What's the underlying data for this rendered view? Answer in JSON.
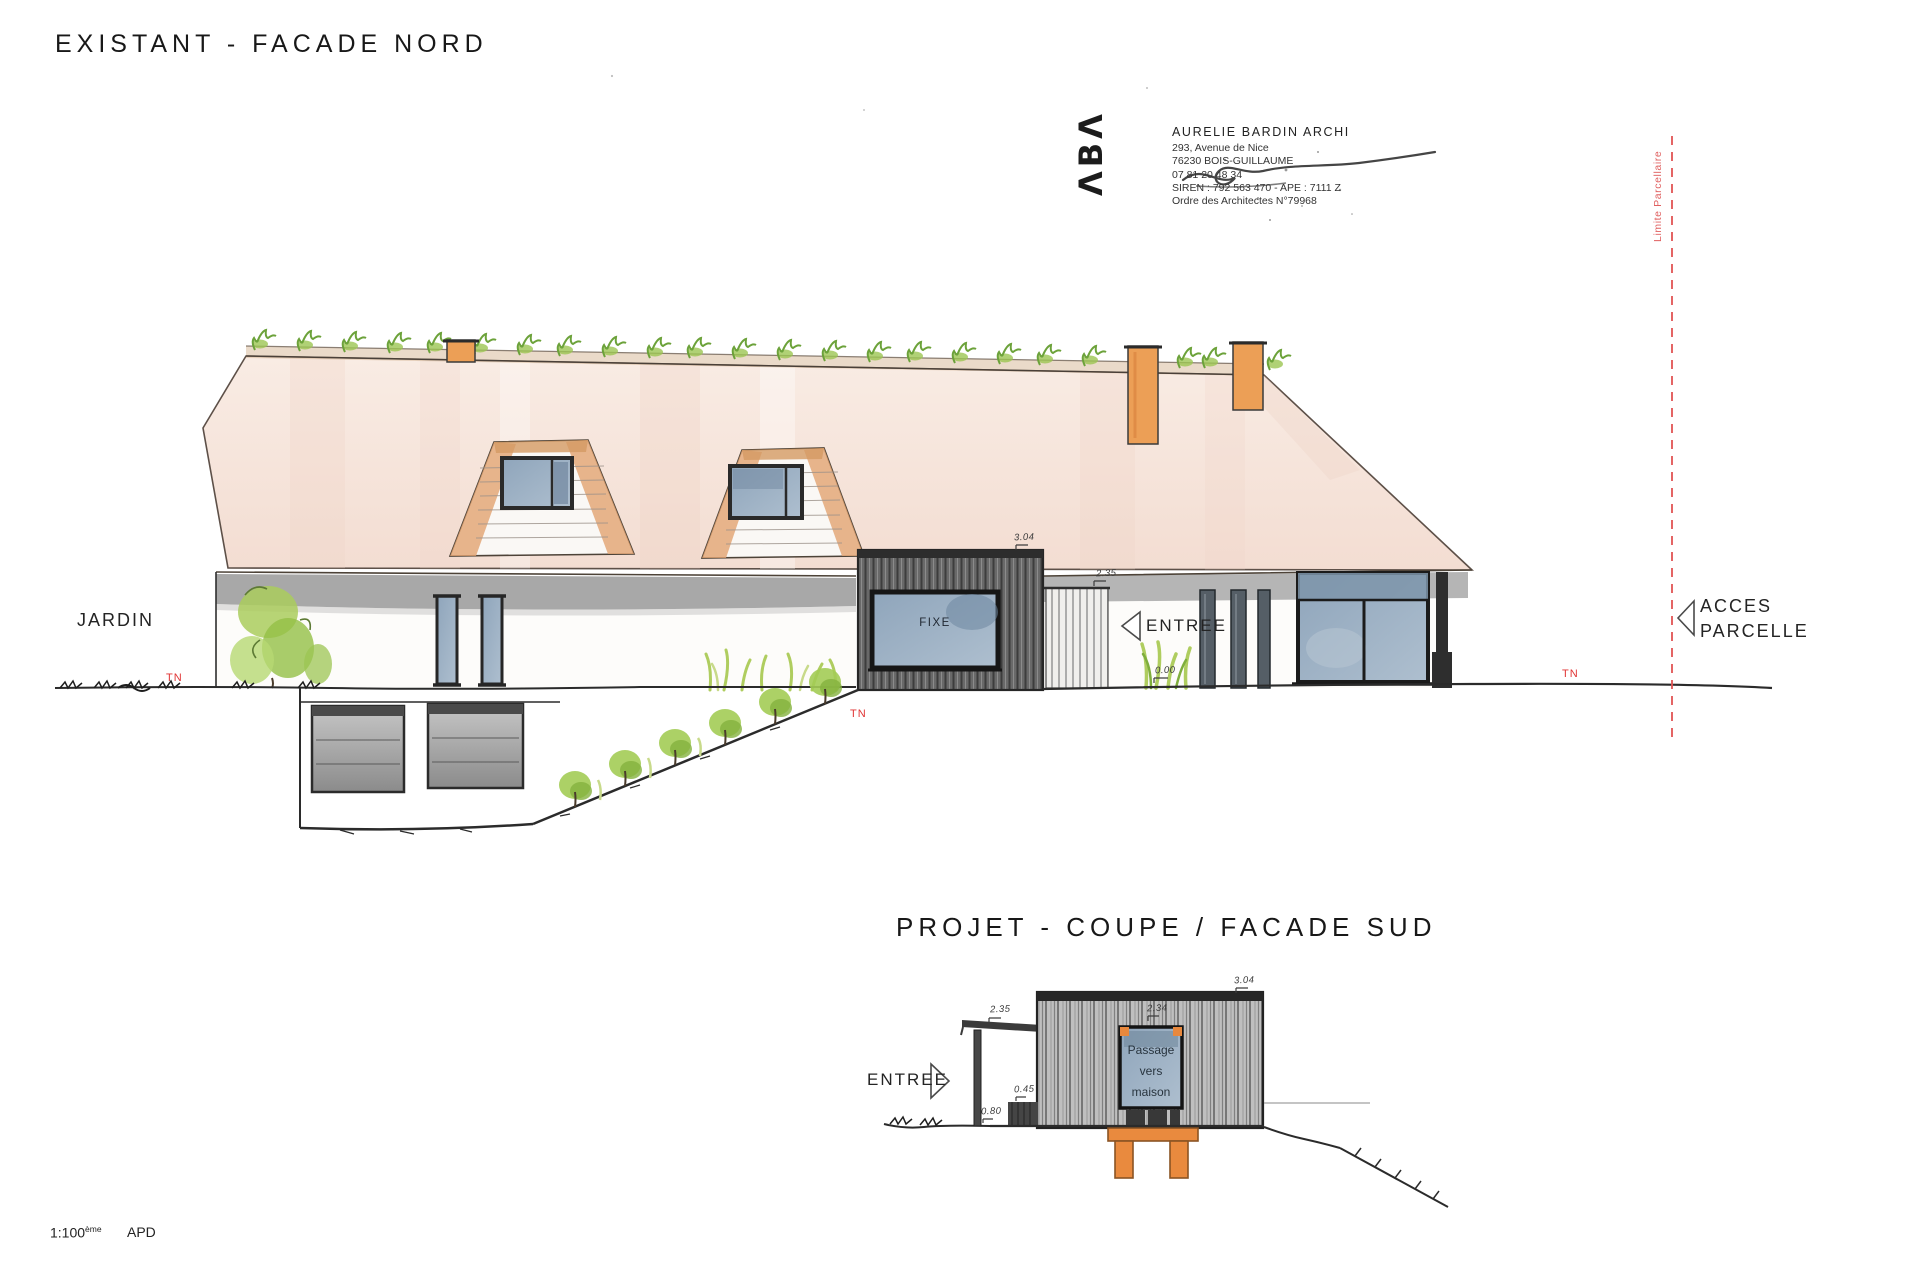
{
  "titles": {
    "existing": "EXISTANT - FACADE NORD",
    "project": "PROJET - COUPE / FACADE SUD"
  },
  "stamp": {
    "logo": "ΛBΛ",
    "name": "AURELIE BARDIN ARCHI",
    "address1": "293, Avenue de Nice",
    "address2": "76230 BOIS-GUILLAUME",
    "phone": "07 81 20 48 34",
    "siren": "SIREN : 792 563 470 - APE : 7111 Z",
    "ordre": "Ordre des Architectes N°79968"
  },
  "labels": {
    "jardin": "JARDIN",
    "entree": "ENTREE",
    "acces_line1": "ACCES",
    "acces_line2": "PARCELLE",
    "limite_parcellaire": "Limite Parcellaire",
    "fixe": "FIXE",
    "tn": "TN",
    "passage": [
      "Passage",
      "vers",
      "maison"
    ]
  },
  "dimensions": {
    "main_box_height": "3.04",
    "main_eave_height": "2.35",
    "main_ground_level": "0.00",
    "section_canopy_height": "2.35",
    "section_box_height": "3.04",
    "section_window_height": "2.34",
    "section_dim_a": "0.45",
    "section_dim_b": "0.80"
  },
  "scale": {
    "ratio": "1:100",
    "suffix": "ème",
    "phase": "APD"
  },
  "colors": {
    "accent_red": "#e03434",
    "chimney_orange": "#ec9f56",
    "roof_wash": "#f6e3d9",
    "glass_blue": "#93a9bf",
    "ink": "#2b2b2b"
  }
}
